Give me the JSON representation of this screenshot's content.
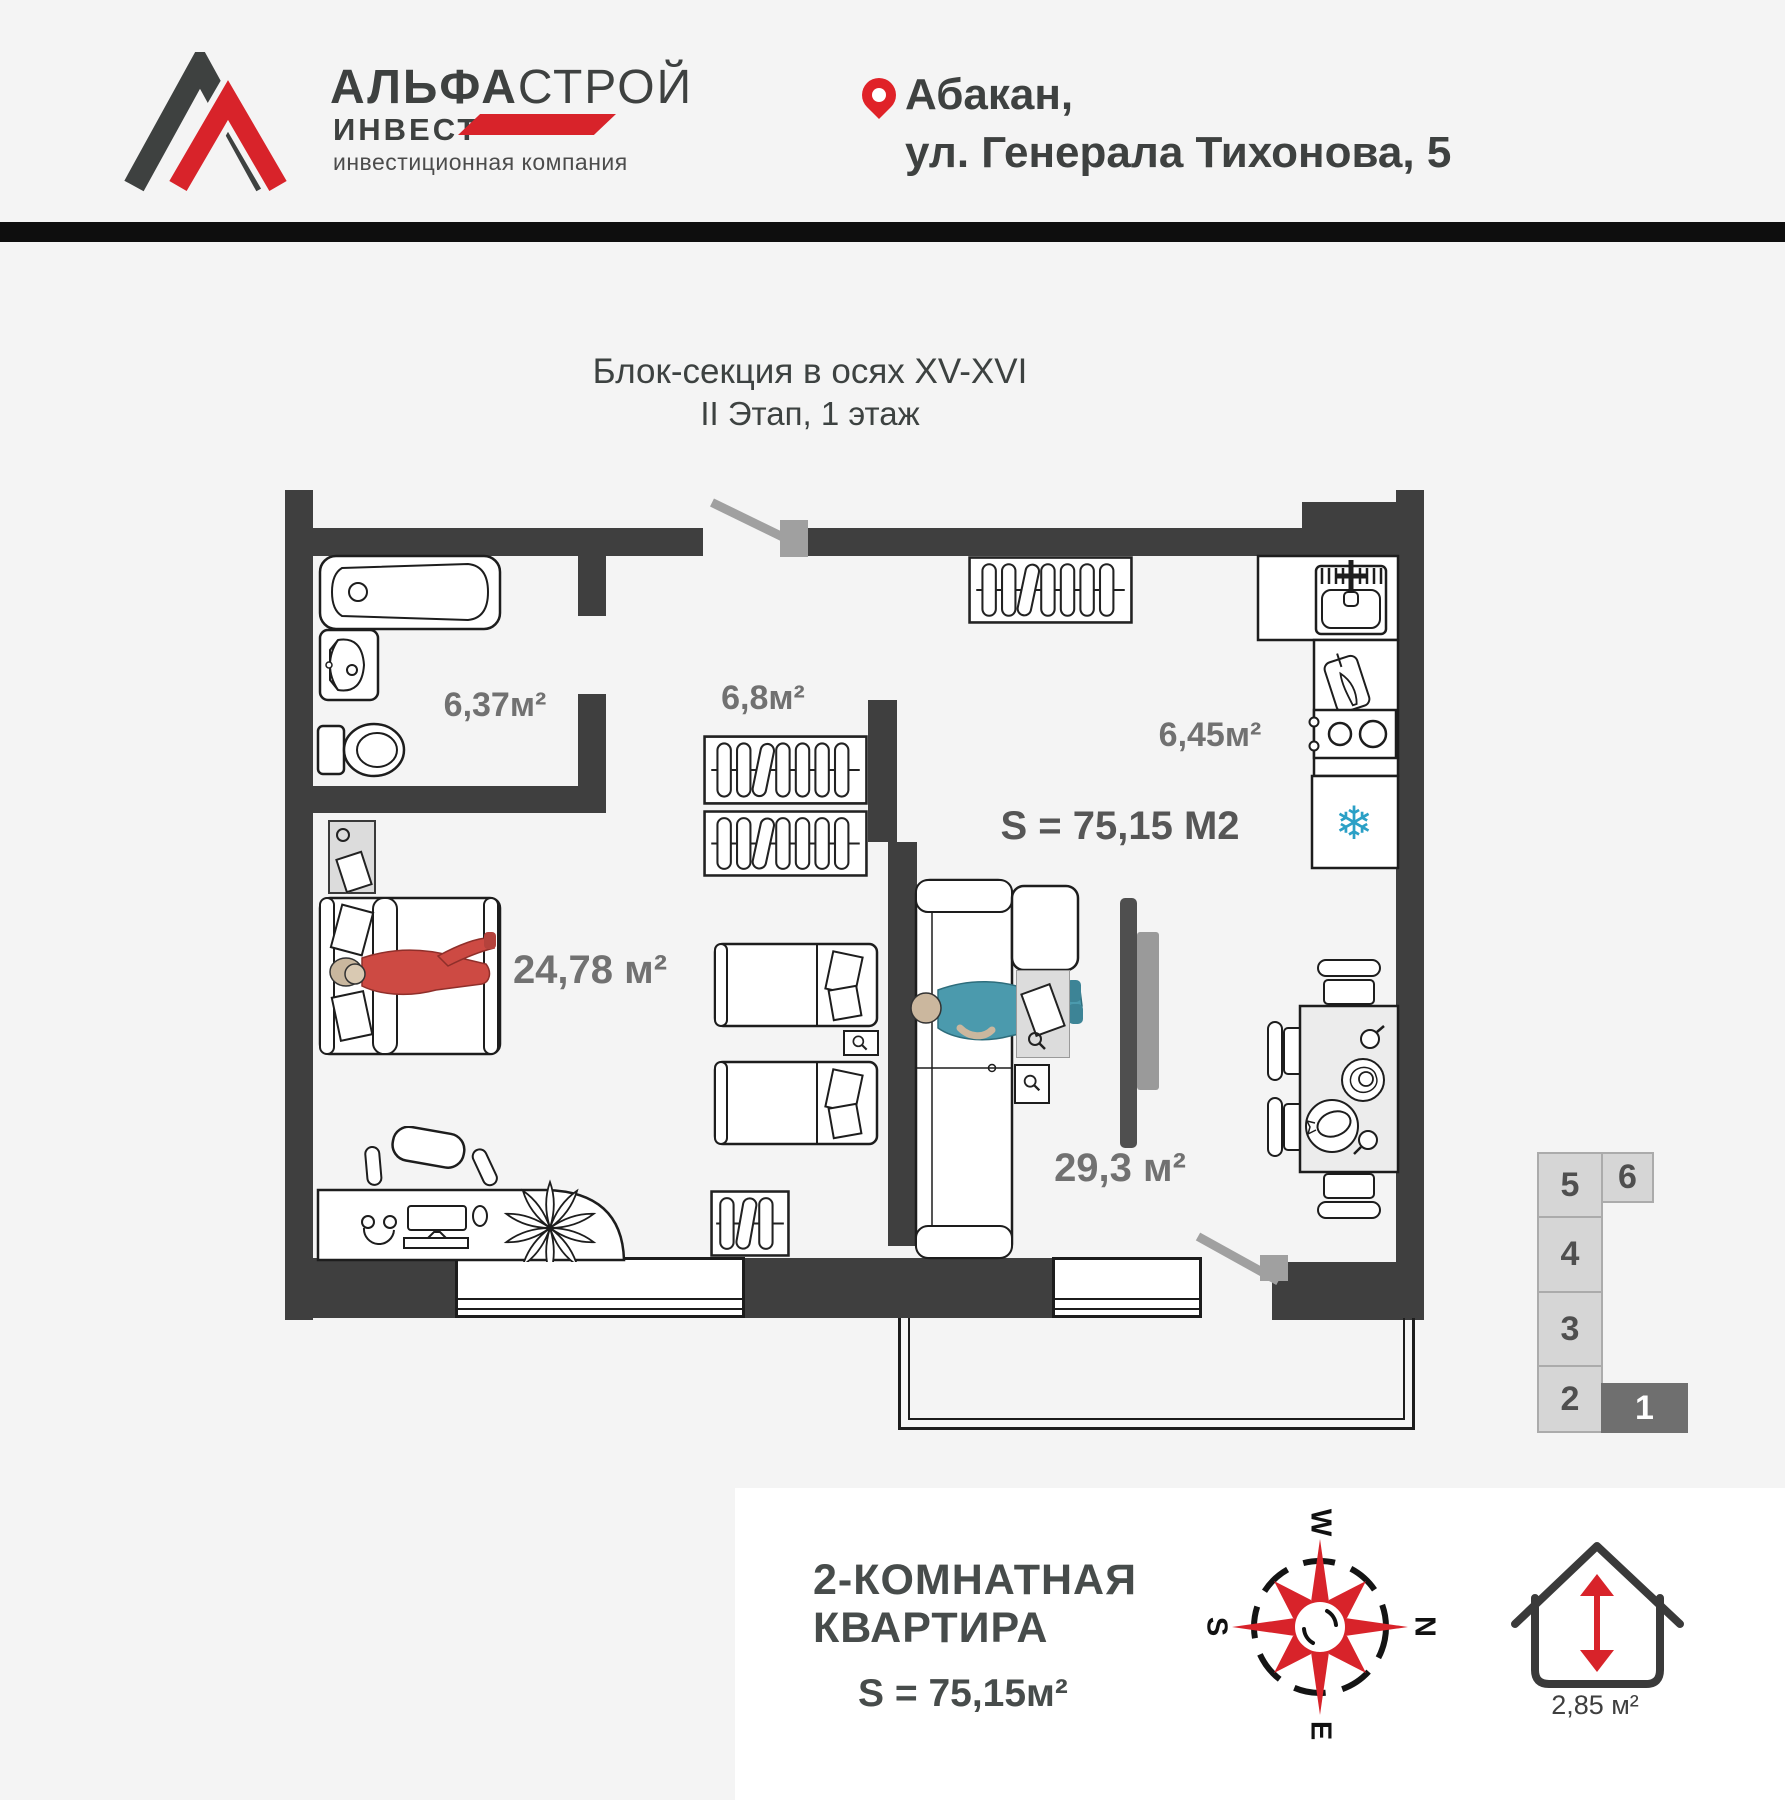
{
  "colors": {
    "background": "#f4f4f4",
    "wall": "#3f3f3f",
    "accent_red": "#d8232a",
    "text_dark": "#3e4140",
    "label_gray": "#717171",
    "snowflake_blue": "#2ba0c6",
    "door_gray": "#a0a0a0",
    "section_cell": "#d6d6d6",
    "section_active": "#6f6f6f"
  },
  "header": {
    "logo": {
      "title_bold": "АЛЬФА",
      "title_light": "СТРОЙ",
      "subtitle": "ИНВЕСТ",
      "tagline": "инвестиционная компания"
    },
    "address": {
      "line1": "Абакан,",
      "line2": "ул. Генерала Тихонова, 5"
    }
  },
  "plan": {
    "title": {
      "line1": "Блок-секция в осях XV-XVI",
      "line2": "II Этап, 1 этаж"
    },
    "total_area": "S = 75,15 М2",
    "rooms": {
      "bathroom": "6,37м²",
      "hall": "6,8м²",
      "kitchen": "6,45м²",
      "bedroom": "24,78 м²",
      "living": "29,3 м²"
    }
  },
  "section": {
    "cells": [
      "5",
      "6",
      "4",
      "3",
      "2",
      "1"
    ]
  },
  "footer": {
    "title_line1": "2-КОМНАТНАЯ",
    "title_line2": "КВАРТИРА",
    "area": "S = 75,15м²",
    "balcony_area": "2,85 м²",
    "compass": {
      "top": "W",
      "right": "N",
      "bottom": "E",
      "left": "S"
    }
  },
  "icons": {
    "snowflake": "❄"
  }
}
